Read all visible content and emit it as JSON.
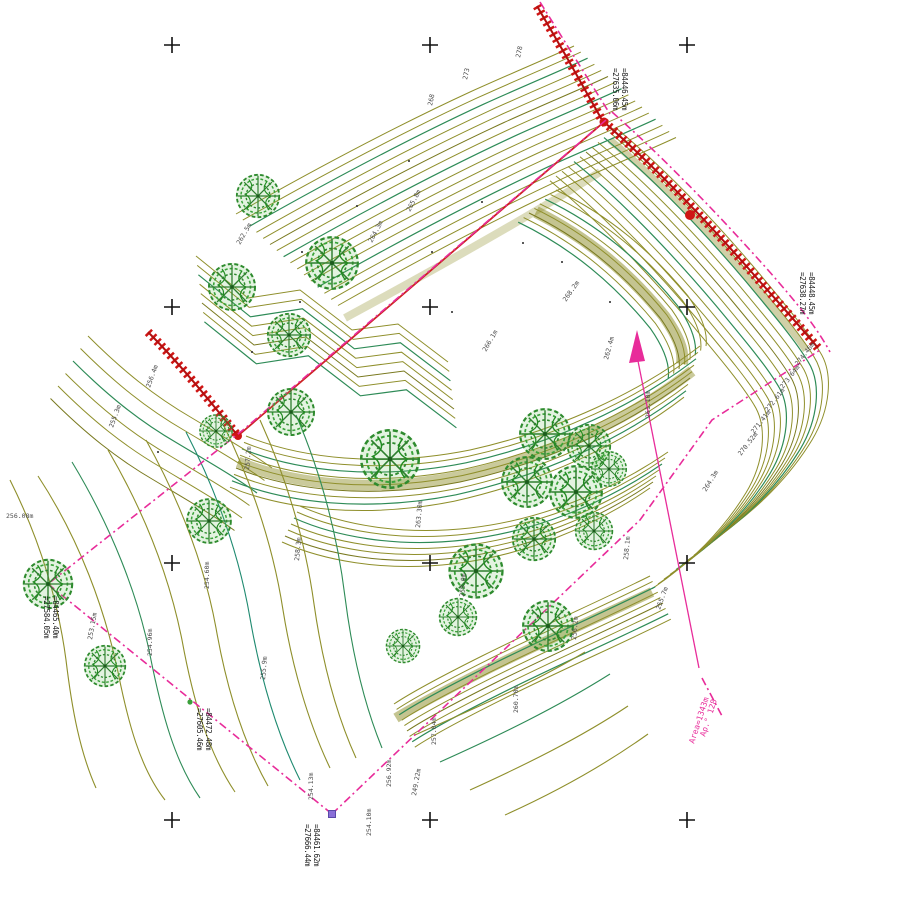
{
  "drawing": {
    "kind": "topographic-survey-plan",
    "background": "#ffffff"
  },
  "colors": {
    "contour_olive": "#8f8f2b",
    "contour_olive_dark": "#79791f",
    "contour_green": "#2e8b57",
    "contour_teal": "#1f8a70",
    "contour_mass": "#8a8a22",
    "slope_red": "#cf1615",
    "slope_red_core": "#b01010",
    "boundary_magenta": "#e82c9a",
    "tree_green": "#2e8b2e",
    "label_gray": "#4a4a4a",
    "station_text": "#1c1c1c",
    "marker_violet": "#8a6fd8",
    "marker_green": "#3aa03a",
    "grid_cross": "#111111"
  },
  "grid": {
    "cross_symbol": "+",
    "columns": [
      172,
      430,
      687
    ],
    "rows": [
      45,
      307,
      563,
      820
    ]
  },
  "stations": [
    {
      "id": "station-top-right",
      "x": 613,
      "y": 68,
      "line1": "=27635.06m",
      "line2": "=84446.45m",
      "marker": "none"
    },
    {
      "id": "station-right",
      "x": 800,
      "y": 272,
      "line1": "=27638.27m",
      "line2": "=84448.45m",
      "marker": "none"
    },
    {
      "id": "station-left",
      "x": 197,
      "y": 708,
      "line1": "=27605.46m",
      "line2": "=84472.48m",
      "marker": "green-dot",
      "mx": 190,
      "my": 702
    },
    {
      "id": "station-sw-corner",
      "x": 44,
      "y": 596,
      "line1": "=27584.05m",
      "line2": "=84465.40m",
      "marker": "none"
    },
    {
      "id": "station-south-vertex",
      "x": 305,
      "y": 824,
      "line1": "=27666.44m",
      "line2": "=84461.62m",
      "marker": "violet-square",
      "mx": 332,
      "my": 814
    }
  ],
  "parcel_label": {
    "line1": "Αρ.° 128",
    "line2": "Area=1343m",
    "x1": 705,
    "y1": 737,
    "x2": 694,
    "y2": 744,
    "rotation": -72
  },
  "contour_labels": [
    {
      "x": 520,
      "y": 58,
      "r": -78,
      "t": "278"
    },
    {
      "x": 467,
      "y": 80,
      "r": -78,
      "t": "273"
    },
    {
      "x": 432,
      "y": 106,
      "r": -78,
      "t": "268"
    },
    {
      "x": 798,
      "y": 366,
      "r": -52,
      "t": "274.46m"
    },
    {
      "x": 783,
      "y": 389,
      "r": -52,
      "t": "273.64m"
    },
    {
      "x": 768,
      "y": 412,
      "r": -52,
      "t": "272.61m"
    },
    {
      "x": 754,
      "y": 434,
      "r": -52,
      "t": "271.41m"
    },
    {
      "x": 741,
      "y": 456,
      "r": -52,
      "t": "270.52m"
    },
    {
      "x": 650,
      "y": 418,
      "r": -90,
      "t": "261.10m"
    },
    {
      "x": 608,
      "y": 360,
      "r": -75,
      "t": "262.4m"
    },
    {
      "x": 706,
      "y": 492,
      "r": -58,
      "t": "264.3m"
    },
    {
      "x": 518,
      "y": 713,
      "r": -90,
      "t": "260.70m"
    },
    {
      "x": 436,
      "y": 745,
      "r": -90,
      "t": "257.84m"
    },
    {
      "x": 391,
      "y": 787,
      "r": -90,
      "t": "256.92m"
    },
    {
      "x": 313,
      "y": 800,
      "r": -90,
      "t": "254.13m"
    },
    {
      "x": 371,
      "y": 836,
      "r": -90,
      "t": "254.10m"
    },
    {
      "x": 416,
      "y": 796,
      "r": -80,
      "t": "249.22m"
    },
    {
      "x": 209,
      "y": 589,
      "r": -90,
      "t": "254.60m"
    },
    {
      "x": 92,
      "y": 640,
      "r": -80,
      "t": "253.15m"
    },
    {
      "x": 152,
      "y": 656,
      "r": -90,
      "t": "254.96m"
    },
    {
      "x": 6,
      "y": 518,
      "r": 0,
      "t": "256.08m"
    },
    {
      "x": 150,
      "y": 388,
      "r": -70,
      "t": "256.4m"
    },
    {
      "x": 113,
      "y": 428,
      "r": -70,
      "t": "255.3m"
    },
    {
      "x": 249,
      "y": 470,
      "r": -85,
      "t": "257.2m"
    },
    {
      "x": 299,
      "y": 561,
      "r": -85,
      "t": "258.3m"
    },
    {
      "x": 420,
      "y": 528,
      "r": -85,
      "t": "263.30m"
    },
    {
      "x": 464,
      "y": 597,
      "r": -85,
      "t": "259.0m"
    },
    {
      "x": 410,
      "y": 212,
      "r": -62,
      "t": "265.8m"
    },
    {
      "x": 372,
      "y": 243,
      "r": -62,
      "t": "264.3m"
    },
    {
      "x": 566,
      "y": 302,
      "r": -55,
      "t": "268.2m"
    },
    {
      "x": 486,
      "y": 352,
      "r": -60,
      "t": "266.1m"
    },
    {
      "x": 576,
      "y": 640,
      "r": -85,
      "t": "256.2m"
    },
    {
      "x": 628,
      "y": 560,
      "r": -85,
      "t": "258.1m"
    },
    {
      "x": 660,
      "y": 610,
      "r": -70,
      "t": "255.7m"
    },
    {
      "x": 265,
      "y": 680,
      "r": -85,
      "t": "255.9m"
    },
    {
      "x": 240,
      "y": 245,
      "r": -60,
      "t": "262.5m"
    }
  ],
  "trees": [
    {
      "x": 258,
      "y": 196,
      "s": 0.92
    },
    {
      "x": 232,
      "y": 287,
      "s": 1.0
    },
    {
      "x": 332,
      "y": 263,
      "s": 1.12
    },
    {
      "x": 289,
      "y": 335,
      "s": 0.92
    },
    {
      "x": 216,
      "y": 431,
      "s": 0.7
    },
    {
      "x": 291,
      "y": 412,
      "s": 1.0
    },
    {
      "x": 390,
      "y": 459,
      "s": 1.25
    },
    {
      "x": 209,
      "y": 521,
      "s": 0.95
    },
    {
      "x": 105,
      "y": 666,
      "s": 0.88
    },
    {
      "x": 48,
      "y": 584,
      "s": 1.05
    },
    {
      "x": 476,
      "y": 571,
      "s": 1.15
    },
    {
      "x": 545,
      "y": 434,
      "s": 1.08
    },
    {
      "x": 589,
      "y": 446,
      "s": 0.92
    },
    {
      "x": 527,
      "y": 482,
      "s": 1.08
    },
    {
      "x": 576,
      "y": 492,
      "s": 1.12
    },
    {
      "x": 609,
      "y": 469,
      "s": 0.75
    },
    {
      "x": 534,
      "y": 539,
      "s": 0.92
    },
    {
      "x": 594,
      "y": 531,
      "s": 0.8
    },
    {
      "x": 548,
      "y": 626,
      "s": 1.08
    },
    {
      "x": 403,
      "y": 646,
      "s": 0.72
    },
    {
      "x": 458,
      "y": 617,
      "s": 0.8
    }
  ],
  "spot_points": [
    [
      409,
      161
    ],
    [
      357,
      206
    ],
    [
      302,
      252
    ],
    [
      482,
      202
    ],
    [
      432,
      252
    ],
    [
      523,
      243
    ],
    [
      562,
      262
    ],
    [
      300,
      302
    ],
    [
      252,
      352
    ],
    [
      452,
      312
    ],
    [
      610,
      302
    ],
    [
      158,
      452
    ]
  ],
  "icons": {
    "tree": "tree-icon",
    "grid_cross": "grid-cross-icon",
    "north_arrow": "north-arrow-icon",
    "vertex_marker": "vertex-marker-icon"
  }
}
